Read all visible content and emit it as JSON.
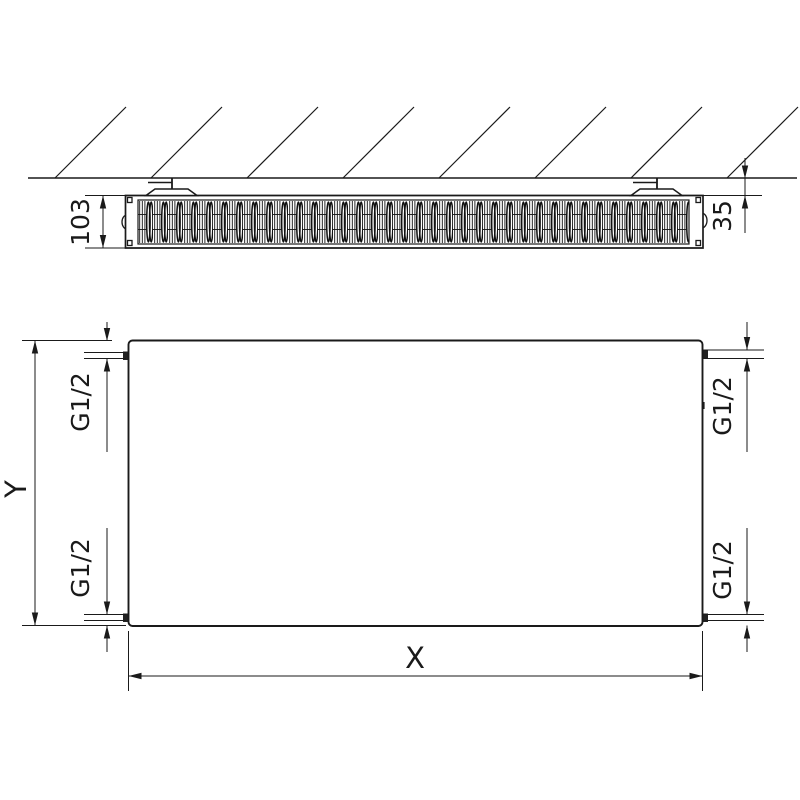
{
  "diagram": {
    "views": {
      "top": {
        "depth_label": "103",
        "wall_distance_label": "35"
      },
      "front": {
        "height_label": "Y",
        "width_label": "X",
        "connections": {
          "top_left": "G1/2",
          "top_right": "G1/2",
          "bottom_left": "G1/2",
          "bottom_right": "G1/2"
        }
      }
    },
    "colors": {
      "line": "#1a1a1a",
      "background": "#ffffff"
    }
  }
}
